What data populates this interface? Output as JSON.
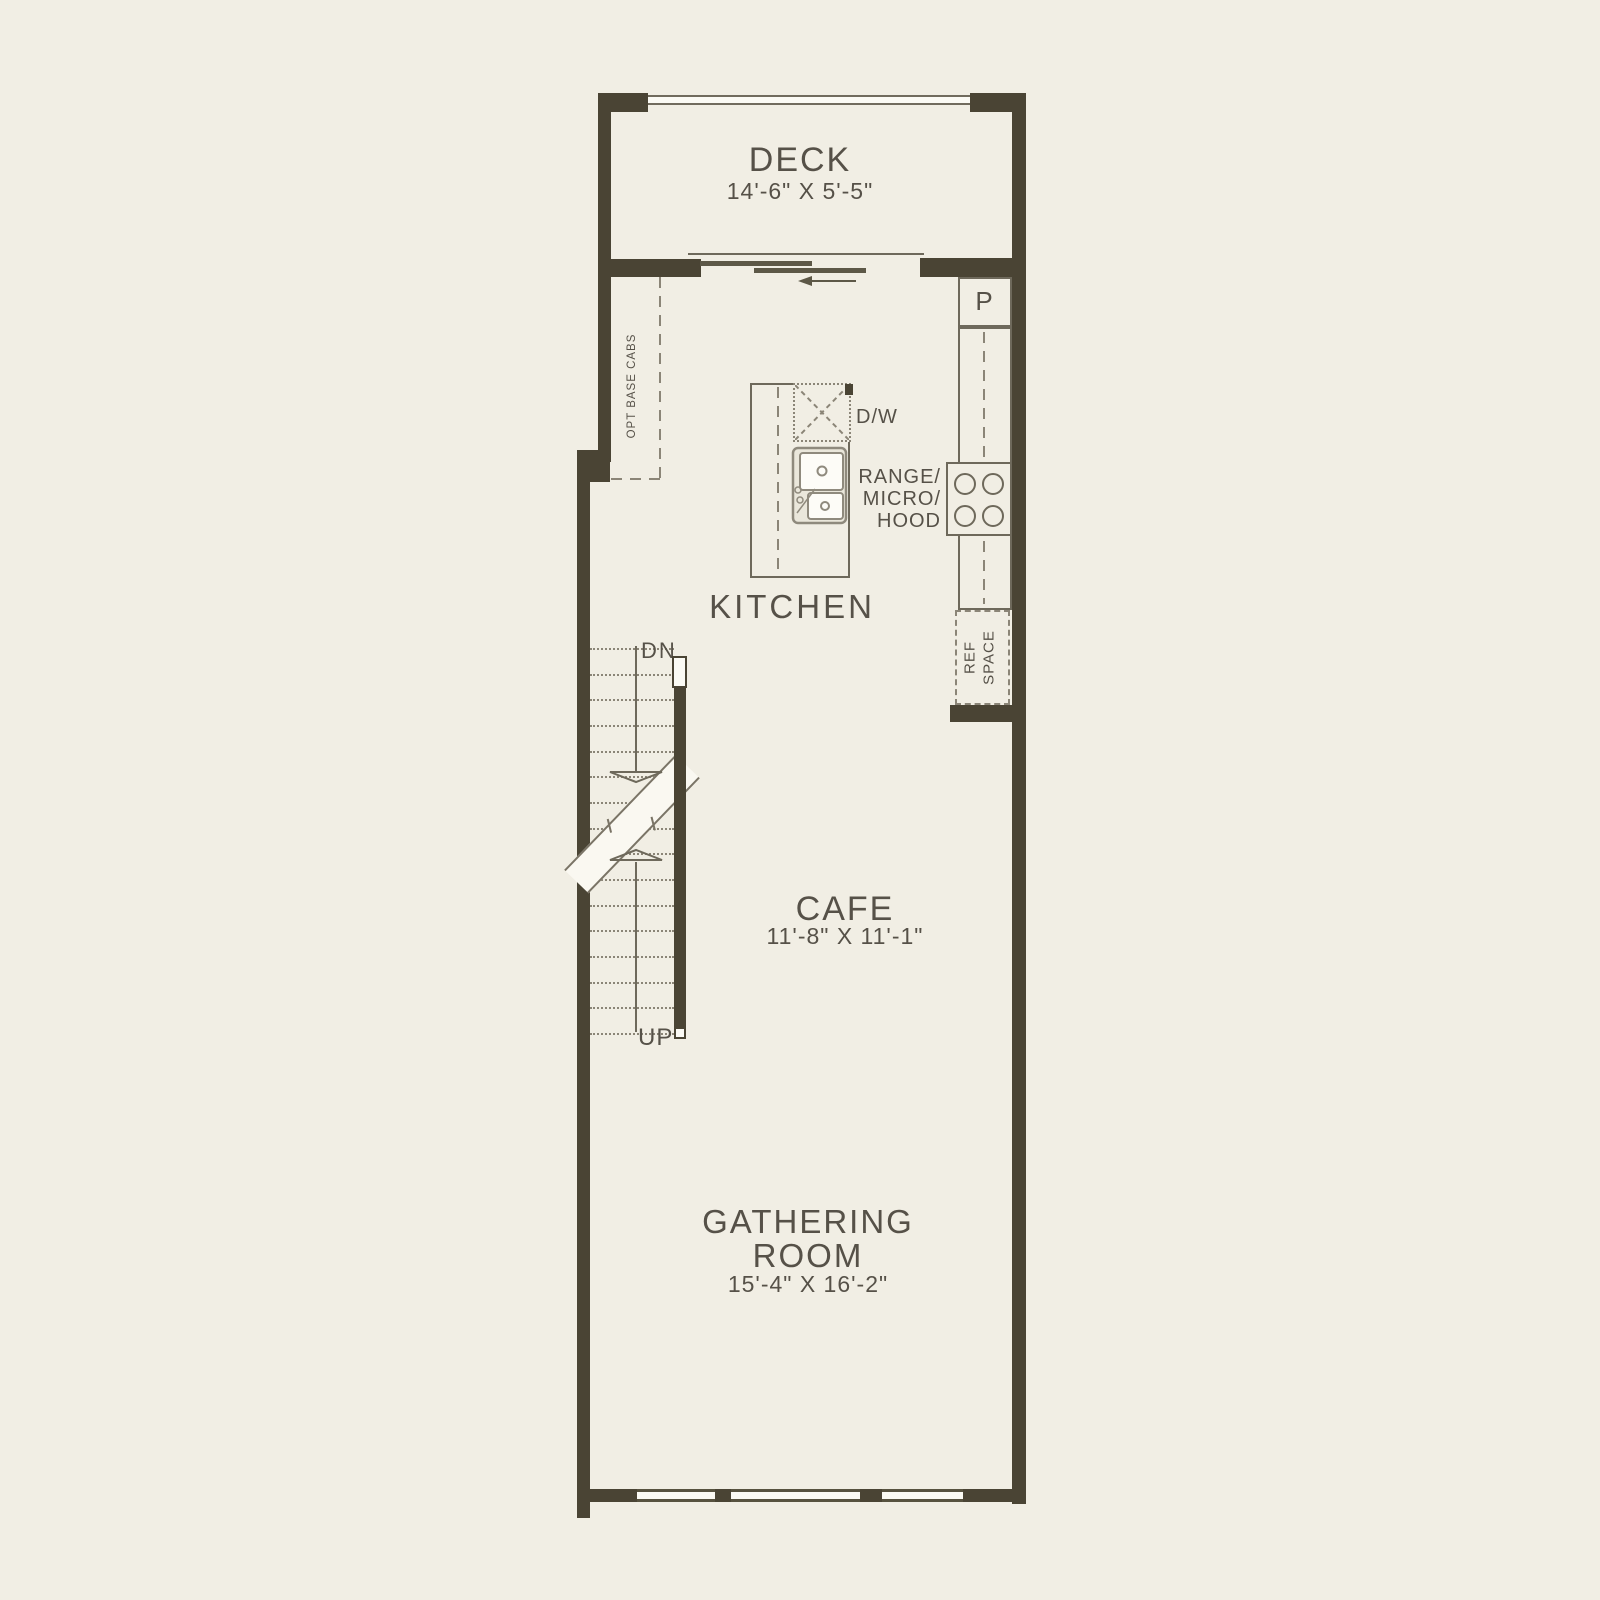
{
  "rooms": {
    "deck": {
      "label": "DECK",
      "dims": "14'-6\" X 5'-5\""
    },
    "kitchen": {
      "label": "KITCHEN"
    },
    "cafe": {
      "label": "CAFE",
      "dims": "11'-8\" X 11'-1\""
    },
    "gathering": {
      "line1": "GATHERING",
      "line2": "ROOM",
      "dims": "15'-4\" X 16'-2\""
    }
  },
  "fixtures": {
    "pantry": "P",
    "dishwasher": "D/W",
    "range": {
      "line1": "RANGE/",
      "line2": "MICRO/",
      "line3": "HOOD"
    },
    "ref": {
      "line1": "REF",
      "line2": "SPACE"
    },
    "opt_base_cabs": "OPT BASE CABS"
  },
  "stairs": {
    "down": "DN",
    "up": "UP"
  },
  "colors": {
    "wall": "#4a4434",
    "line": "#6e695b",
    "text": "#565148",
    "background": "#f1eee4",
    "paper": "#fbfaf4"
  }
}
